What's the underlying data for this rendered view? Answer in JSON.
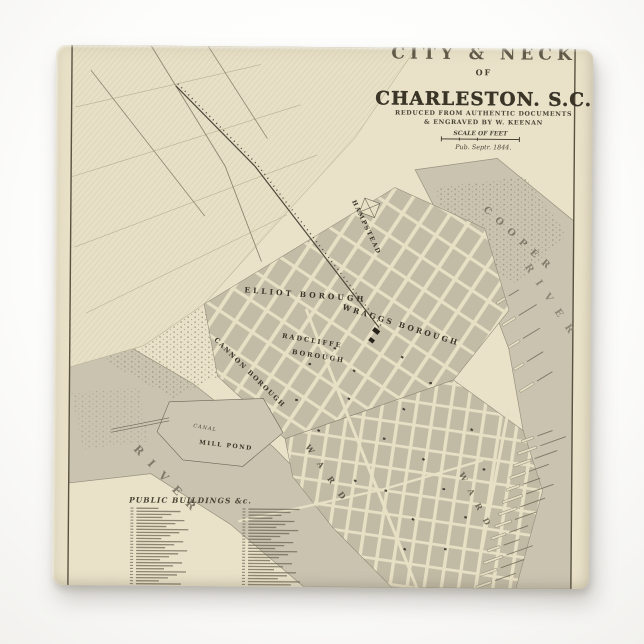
{
  "product": {
    "kind_label": "ceramic tile product photo",
    "background_color": "#fdfdfc",
    "shadow_color": "#696255"
  },
  "tile": {
    "paper_color": "#e9e1c8",
    "ink_color": "#433d2f",
    "water_color": "#c9c3b0",
    "block_color": "#c2bba6",
    "street_color": "#e8e0c5",
    "pond_color": "#cdc6b2"
  },
  "title_block": {
    "title_top": "CITY & NECK",
    "title_of": "OF",
    "title_main": "CHARLESTON. S.C.",
    "credit_line1": "REDUCED FROM AUTHENTIC DOCUMENTS",
    "credit_line2": "& ENGRAVED BY W. KEENAN",
    "scale_label": "SCALE OF FEET",
    "pub_line": "Pub. Septr. 1844."
  },
  "labels": {
    "elliot_borough": "ELLIOT BOROUGH",
    "wraggs_borough": "WRAGGS BOROUGH",
    "radcliffe_line1": "RADCLIFFE",
    "radcliffe_line2": "BOROUGH",
    "cannon_borough": "CANNON BOROUGH",
    "hampstead": "HAMPSTEAD",
    "mill_pond": "MILL POND",
    "canal": "CANAL",
    "cooper_letters": "COOPER",
    "cooper_river_letters": "RIVER",
    "ashley_river_letters": "RIVER",
    "ward_letters": "WARD"
  },
  "legend": {
    "heading": "PUBLIC BUILDINGS &c."
  }
}
